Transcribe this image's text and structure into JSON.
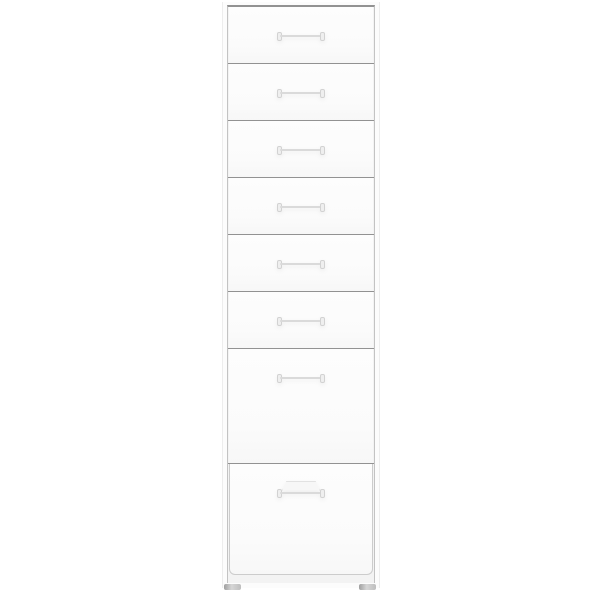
{
  "image": {
    "type": "product-photo",
    "subject": "Tall narrow white steel drawer unit with eight drawers on casters",
    "background_color": "#ffffff"
  },
  "cabinet": {
    "body_color": "#fcfcfc",
    "line_color": "#929292",
    "side_line_color": "#c3c3c3",
    "handle_color": "#dadada",
    "drawer_count": 8,
    "small_drawer_count": 6,
    "large_drawer_count": 2,
    "drawers": [
      {
        "id": 1,
        "size": "small",
        "handle": "wire"
      },
      {
        "id": 2,
        "size": "small",
        "handle": "wire"
      },
      {
        "id": 3,
        "size": "small",
        "handle": "wire"
      },
      {
        "id": 4,
        "size": "small",
        "handle": "wire"
      },
      {
        "id": 5,
        "size": "small",
        "handle": "wire"
      },
      {
        "id": 6,
        "size": "small",
        "handle": "wire"
      },
      {
        "id": 7,
        "size": "large",
        "handle": "wire"
      },
      {
        "id": 8,
        "size": "large",
        "handle": "label-plate"
      }
    ],
    "feet": {
      "count": 2,
      "color": "#a9a9a9"
    }
  }
}
